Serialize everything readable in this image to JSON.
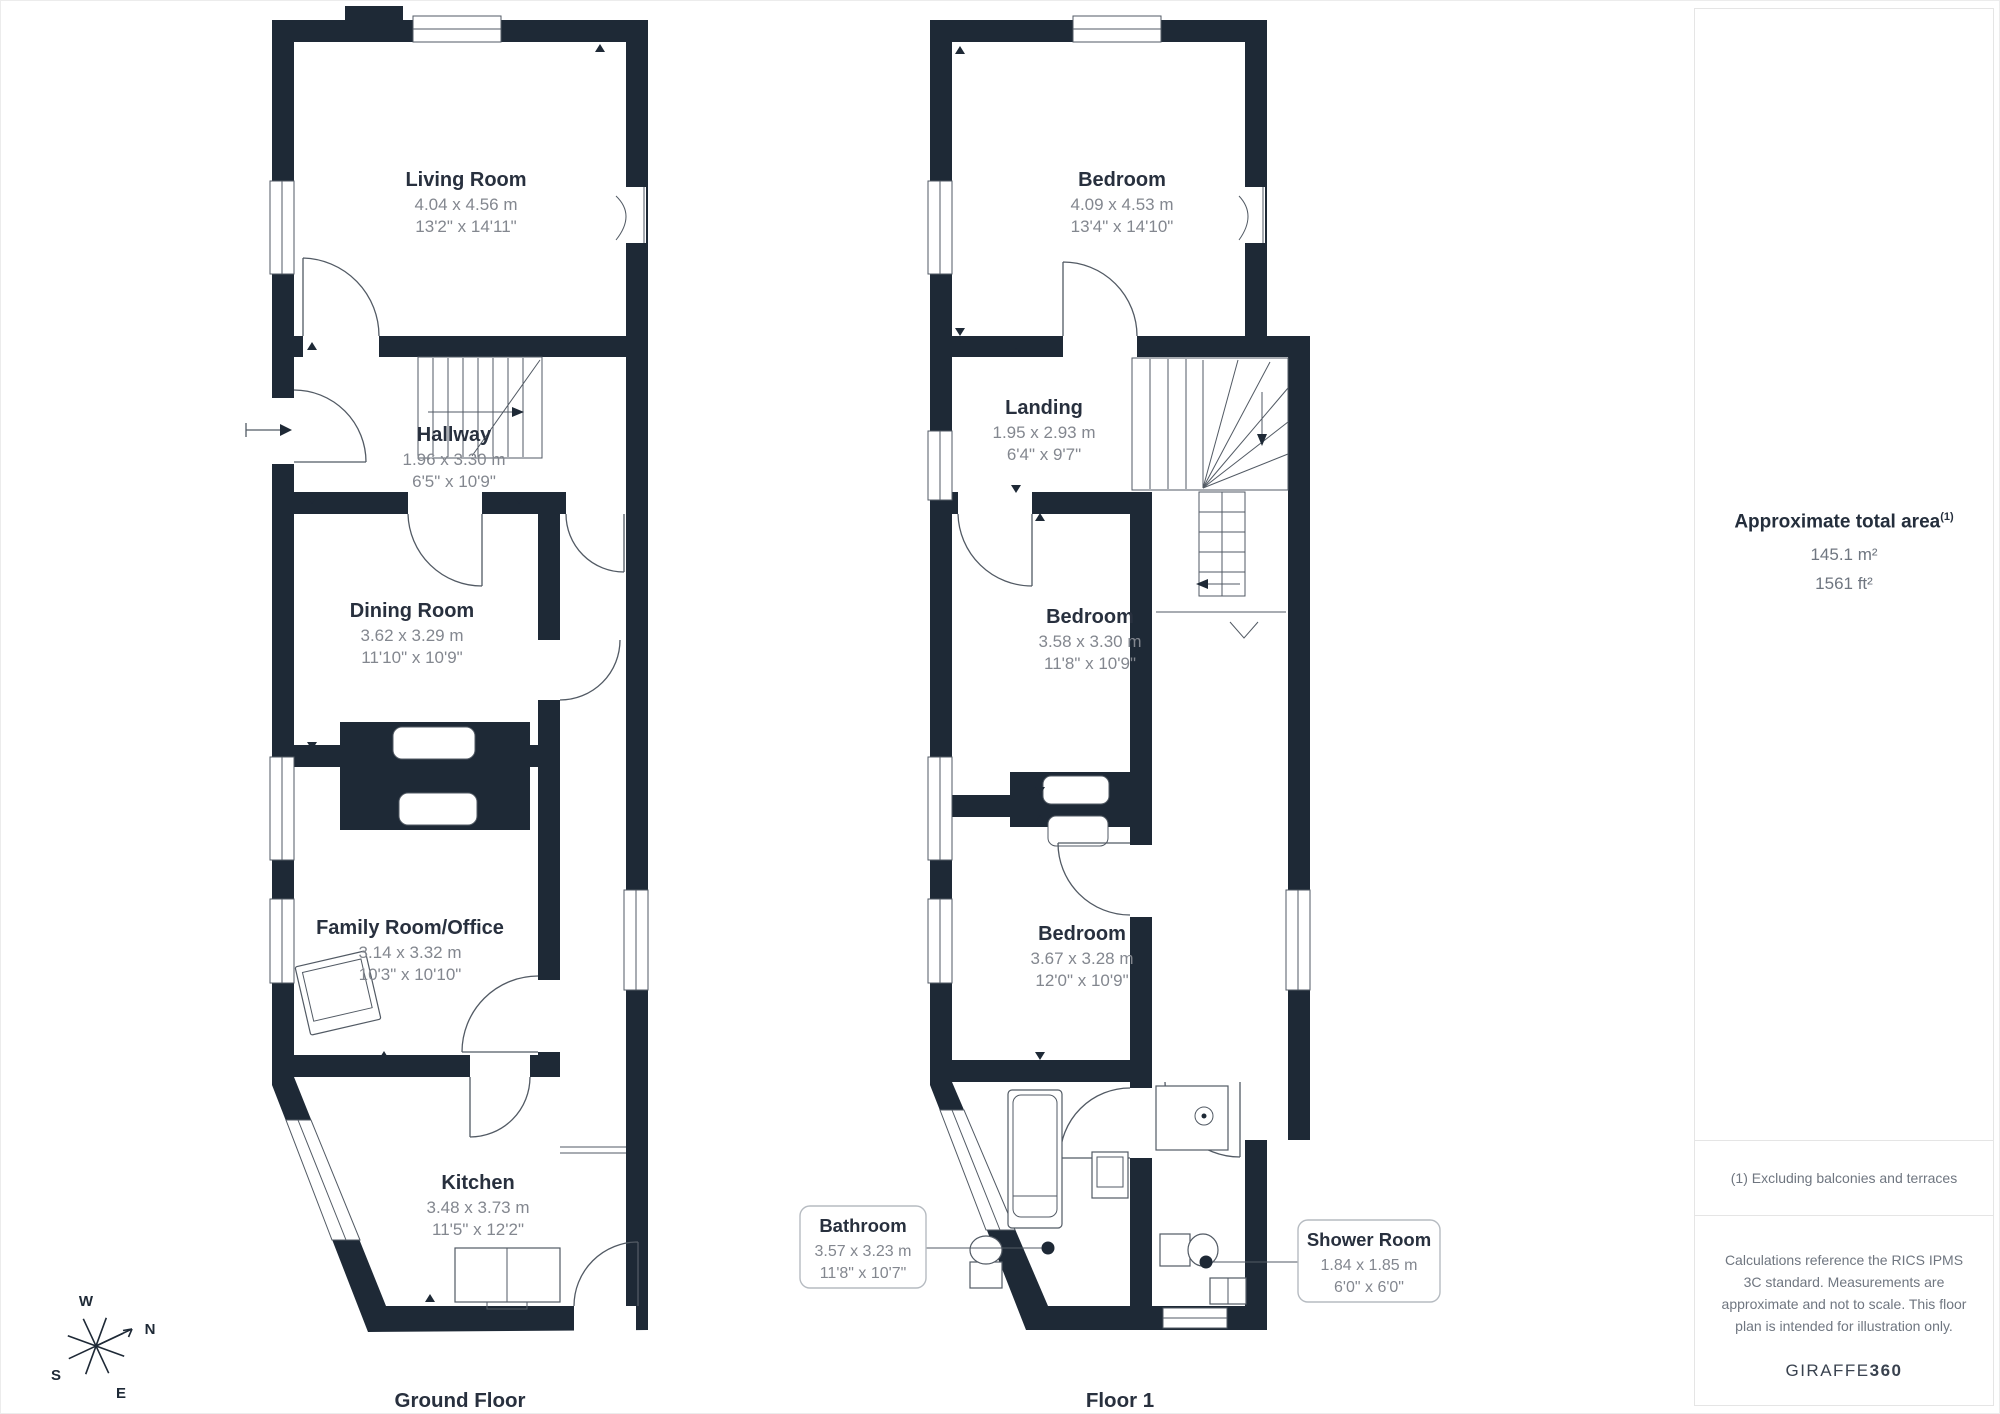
{
  "colors": {
    "wall": "#1e2936",
    "room": "#ffffff",
    "label": "#28303e",
    "dimension_text": "#83878f",
    "note_text": "#6f7680",
    "border": "#e5e5e5"
  },
  "floors": [
    {
      "label": "Ground Floor",
      "rooms": [
        {
          "name": "Living Room",
          "metric": "4.04 x 4.56 m",
          "imperial": "13'2\" x 14'11\""
        },
        {
          "name": "Hallway",
          "metric": "1.96 x 3.30 m",
          "imperial": "6'5\" x 10'9\""
        },
        {
          "name": "Dining Room",
          "metric": "3.62 x 3.29 m",
          "imperial": "11'10\" x 10'9\""
        },
        {
          "name": "Family Room/Office",
          "metric": "3.14 x 3.32 m",
          "imperial": "10'3\" x 10'10\""
        },
        {
          "name": "Kitchen",
          "metric": "3.48 x 3.73 m",
          "imperial": "11'5\" x 12'2\""
        }
      ]
    },
    {
      "label": "Floor 1",
      "rooms": [
        {
          "name": "Bedroom",
          "metric": "4.09 x 4.53 m",
          "imperial": "13'4\" x 14'10\""
        },
        {
          "name": "Landing",
          "metric": "1.95 x 2.93 m",
          "imperial": "6'4\" x 9'7\""
        },
        {
          "name": "Bedroom",
          "metric": "3.58 x 3.30 m",
          "imperial": "11'8\" x 10'9\""
        },
        {
          "name": "Bedroom",
          "metric": "3.67 x 3.28 m",
          "imperial": "12'0\" x 10'9\""
        },
        {
          "name": "Bathroom",
          "metric": "3.57 x 3.23 m",
          "imperial": "11'8\" x 10'7\""
        },
        {
          "name": "Shower Room",
          "metric": "1.84 x 1.85 m",
          "imperial": "6'0\" x 6'0\""
        }
      ]
    }
  ],
  "sidebar": {
    "area_title": "Approximate total area",
    "area_footnote_marker": "(1)",
    "area_metric": "145.1 m²",
    "area_imperial": "1561 ft²",
    "footnote": "(1) Excluding balconies and terraces",
    "disclaimer": "Calculations reference the RICS IPMS 3C standard. Measurements are approximate and not to scale. This floor plan is intended for illustration only.",
    "brand_name": "GIRAFFE",
    "brand_suffix": "360"
  },
  "compass": {
    "north": "N",
    "south": "S",
    "east": "E",
    "west": "W"
  }
}
